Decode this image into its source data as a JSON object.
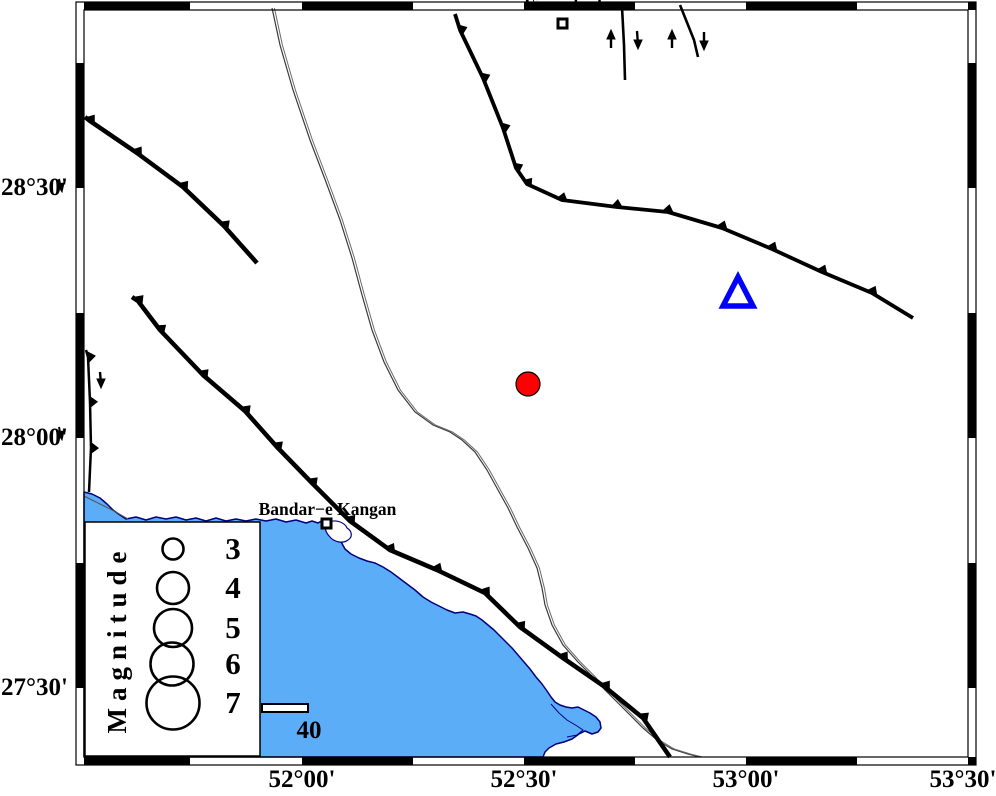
{
  "axis": {
    "lat": [
      "28°30'",
      "28°00'",
      "27°30'"
    ],
    "lon": [
      "52°00'",
      "52°30'",
      "53°00'",
      "53°30'"
    ]
  },
  "cities": {
    "firuzabad": "Firuzabad",
    "bandar_e_kangan": "Bandar−e Kangan"
  },
  "legend": {
    "title": "Magnitude",
    "magnitudes": [
      "3",
      "4",
      "5",
      "6",
      "7"
    ]
  },
  "scale_bar": {
    "label": "40"
  },
  "symbols": {
    "epicenter": {
      "label": "earthquake-epicenter",
      "color": "#FF0000"
    },
    "station": {
      "label": "station-triangle",
      "color": "#0000FF"
    }
  },
  "colors": {
    "sea": "#5BADF8",
    "coastline": "#000080",
    "fault": "#000000",
    "frame": "#000000"
  }
}
